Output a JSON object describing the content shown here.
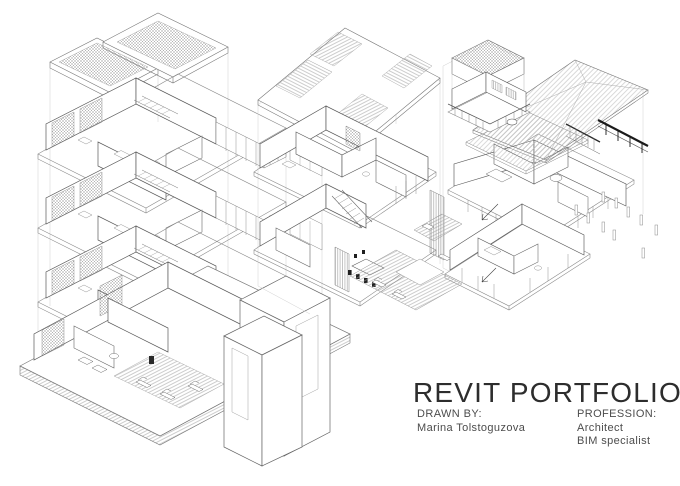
{
  "title": "REVIT PORTFOLIO",
  "credits": {
    "drawn_by_label": "DRAWN BY:",
    "drawn_by_name": "Marina Tolstoguzova",
    "profession_label": "PROFESSION:",
    "profession_lines": [
      "Architect",
      "BIM specialist"
    ]
  },
  "drawings": [
    {
      "name": "exploded-axonometric-apartment-tower",
      "position": "left"
    },
    {
      "name": "exploded-axonometric-flat-roof-house",
      "position": "center"
    },
    {
      "name": "exploded-axonometric-hip-roof-house",
      "position": "right"
    }
  ],
  "colors": {
    "background": "#ffffff",
    "ink": "#2d2d2d",
    "text_secondary": "#4c4c4c",
    "linework": "#6e6e6e",
    "linework_light": "#c9c9c9",
    "accent_dark": "#1b1b1b"
  }
}
